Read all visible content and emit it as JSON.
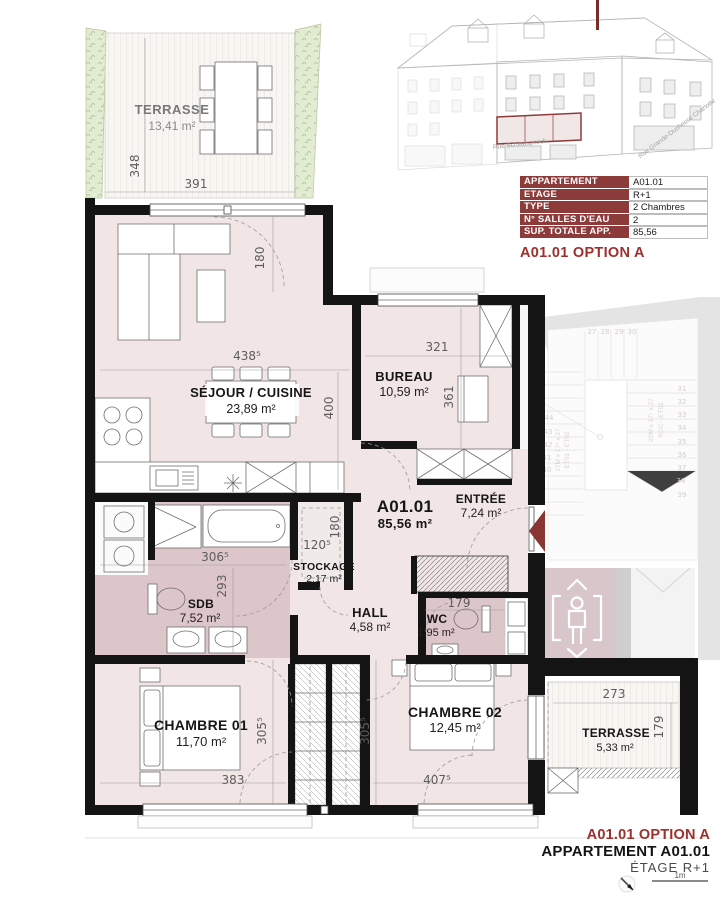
{
  "info_table": {
    "rows": [
      {
        "label": "APPARTEMENT",
        "value": "A01.01"
      },
      {
        "label": "ETAGE",
        "value": "R+1"
      },
      {
        "label": "TYPE",
        "value": "2 Chambres"
      },
      {
        "label": "N° SALLES D'EAU",
        "value": "2"
      },
      {
        "label": "SUP. TOTALE APP. (M²)",
        "value": "85,56"
      }
    ],
    "option_label": "A01.01 OPTION A"
  },
  "elevation": {
    "street_1": "Rue Schlaaspesch",
    "street_2": "Rue Grande-Duchesse Charlotte"
  },
  "unit": {
    "code": "A01.01",
    "area": "85,56 m²"
  },
  "rooms": {
    "terrasse_top": {
      "name": "TERRASSE",
      "area": "13,41 m²"
    },
    "sejour": {
      "name": "SÉJOUR / CUISINE",
      "area": "23,89 m²"
    },
    "bureau": {
      "name": "BUREAU",
      "area": "10,59 m²"
    },
    "entree": {
      "name": "ENTRÉE",
      "area": "7,24 m²"
    },
    "stockage": {
      "name": "STOCKAGE",
      "area": "2,17 m²"
    },
    "sdb": {
      "name": "SDB",
      "area": "7,52 m²"
    },
    "hall": {
      "name": "HALL",
      "area": "4,58 m²"
    },
    "wc": {
      "name": "WC",
      "area": "1,95 m²"
    },
    "chambre_01": {
      "name": "CHAMBRE 01",
      "area": "11,70 m²"
    },
    "chambre_02": {
      "name": "CHAMBRE 02",
      "area": "12,45 m²"
    },
    "terrasse_bottom": {
      "name": "TERRASSE",
      "area": "5,33 m²"
    }
  },
  "dims": {
    "t_top_h": "348",
    "t_top_w": "391",
    "sejour_door": "180",
    "sejour_w": "438⁵",
    "sejour_h": "400",
    "bureau_w": "321",
    "bureau_h": "361",
    "stock_w": "120⁵",
    "stock_h": "180",
    "sdb_w": "306⁵",
    "sdb_h": "293",
    "wc_w": "179",
    "dress1_h": "305⁵",
    "dress2_h": "305⁵",
    "ch1_w": "383",
    "ch2_w": "407⁵",
    "t_bot_w": "273",
    "t_bot_h": "179"
  },
  "stairs": {
    "left": [
      "26",
      "25",
      "24",
      "44",
      "43",
      "42",
      "41",
      "40"
    ],
    "top": [
      "27",
      "28",
      "29",
      "30"
    ],
    "right": [
      "31",
      "32",
      "33",
      "34",
      "35",
      "36",
      "37",
      "38",
      "39"
    ],
    "note_right_1": "22M x 17⁵ x 27",
    "note_right_2": "RDC - ET01",
    "note_left_1": "17M x 17⁵ x 27",
    "note_left_2": "ET01 - ET02"
  },
  "footer": {
    "option": "A01.01 OPTION A",
    "apartment": "APPARTEMENT A01.01",
    "floor": "ÉTAGE R+1",
    "scale": "1m"
  },
  "colors": {
    "accent_red": "#9e2f2c",
    "table_header_bg": "#8d3a3a",
    "wall": "#141414",
    "room_pink": "#f1e6e5",
    "wet_room_pink": "#dcc6c9",
    "elevator_mauve": "#d9c6cb",
    "vegetation_green": "#e2ecd2"
  }
}
